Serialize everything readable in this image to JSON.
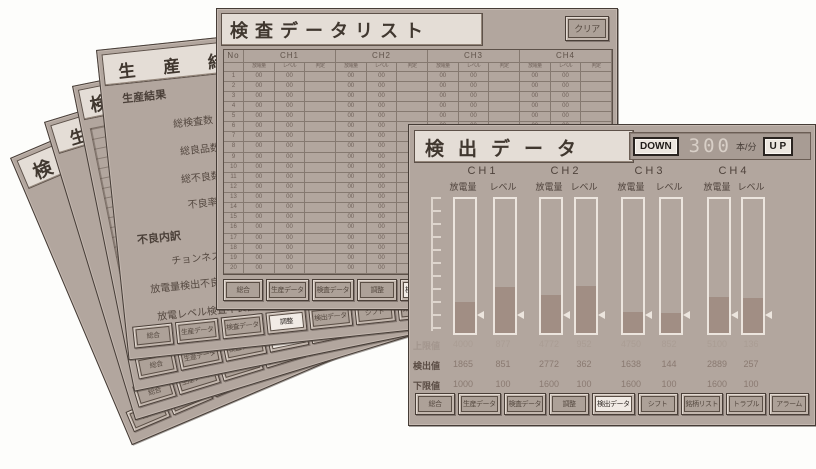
{
  "page_background": "#fdfdfb",
  "colors": {
    "window_bg": "#b2a69e",
    "window_border": "#453c36",
    "title_bg": "#e4ddd6",
    "title_text": "#40372f",
    "bar_outline": "#ece5de",
    "bar_fill": "#a18e84",
    "button_face": "#ada198",
    "button_active_face": "#f1ebe5"
  },
  "front_window": {
    "title": "検出データ",
    "speed": {
      "down_label": "DOWN",
      "value": "300",
      "unit": "本/分",
      "up_label": "U P"
    },
    "channels": [
      {
        "name": "CH1",
        "columns": [
          "放電量",
          "レベル"
        ]
      },
      {
        "name": "CH2",
        "columns": [
          "放電量",
          "レベル"
        ]
      },
      {
        "name": "CH3",
        "columns": [
          "放電量",
          "レベル"
        ]
      },
      {
        "name": "CH4",
        "columns": [
          "放電量",
          "レベル"
        ]
      }
    ],
    "gauges": {
      "fill_percent": [
        23,
        34,
        28,
        35,
        16,
        15,
        27,
        26
      ],
      "marker_percent": [
        12,
        12,
        12,
        12,
        12,
        12,
        12,
        12
      ]
    },
    "value_rows": [
      {
        "label": "上限値",
        "values": [
          "4000",
          "877",
          "4772",
          "952",
          "4750",
          "852",
          "5100",
          "136"
        ],
        "faint": true
      },
      {
        "label": "検出値",
        "values": [
          "1865",
          "851",
          "2772",
          "362",
          "1638",
          "144",
          "2889",
          "257"
        ],
        "faint": false
      },
      {
        "label": "下限値",
        "values": [
          "1000",
          "100",
          "1600",
          "100",
          "1600",
          "100",
          "1600",
          "100"
        ],
        "faint": false
      }
    ],
    "buttons": [
      "総合",
      "生産データ",
      "検査データ",
      "調整",
      "検出データ",
      "シフト",
      "銘柄リスト",
      "トラブル",
      "アラーム"
    ],
    "active_button_index": 4
  },
  "list_window": {
    "title": "検査データリスト",
    "clear_button": "クリア",
    "table": {
      "corner_header": "No",
      "channel_headers": [
        "CH1",
        "CH2",
        "CH3",
        "CH4"
      ],
      "sub_headers": [
        "放電量",
        "レベル",
        "判定"
      ],
      "row_count": 20,
      "row_cell_values": [
        "00",
        "00",
        ""
      ]
    },
    "buttons": [
      "総合",
      "生産データ",
      "検査データ",
      "調整",
      "検出データ",
      "シフト",
      "銘柄リスト",
      "トラブル",
      "アラーム"
    ],
    "active_button_index": 4
  },
  "production_window": {
    "title": "生産結果",
    "sections": [
      {
        "heading": "生産結果",
        "items": [
          "総検査数",
          "総良品数",
          "総不良数",
          "不良率"
        ]
      },
      {
        "heading": "不良内訳",
        "items": [
          "チョンネス",
          "放電量検出不良品",
          "放電レベル検査不良品"
        ]
      }
    ]
  },
  "background_windows": [
    {
      "title": "検出データ"
    },
    {
      "title": "生産結果"
    },
    {
      "title": "検査データリスト"
    }
  ]
}
